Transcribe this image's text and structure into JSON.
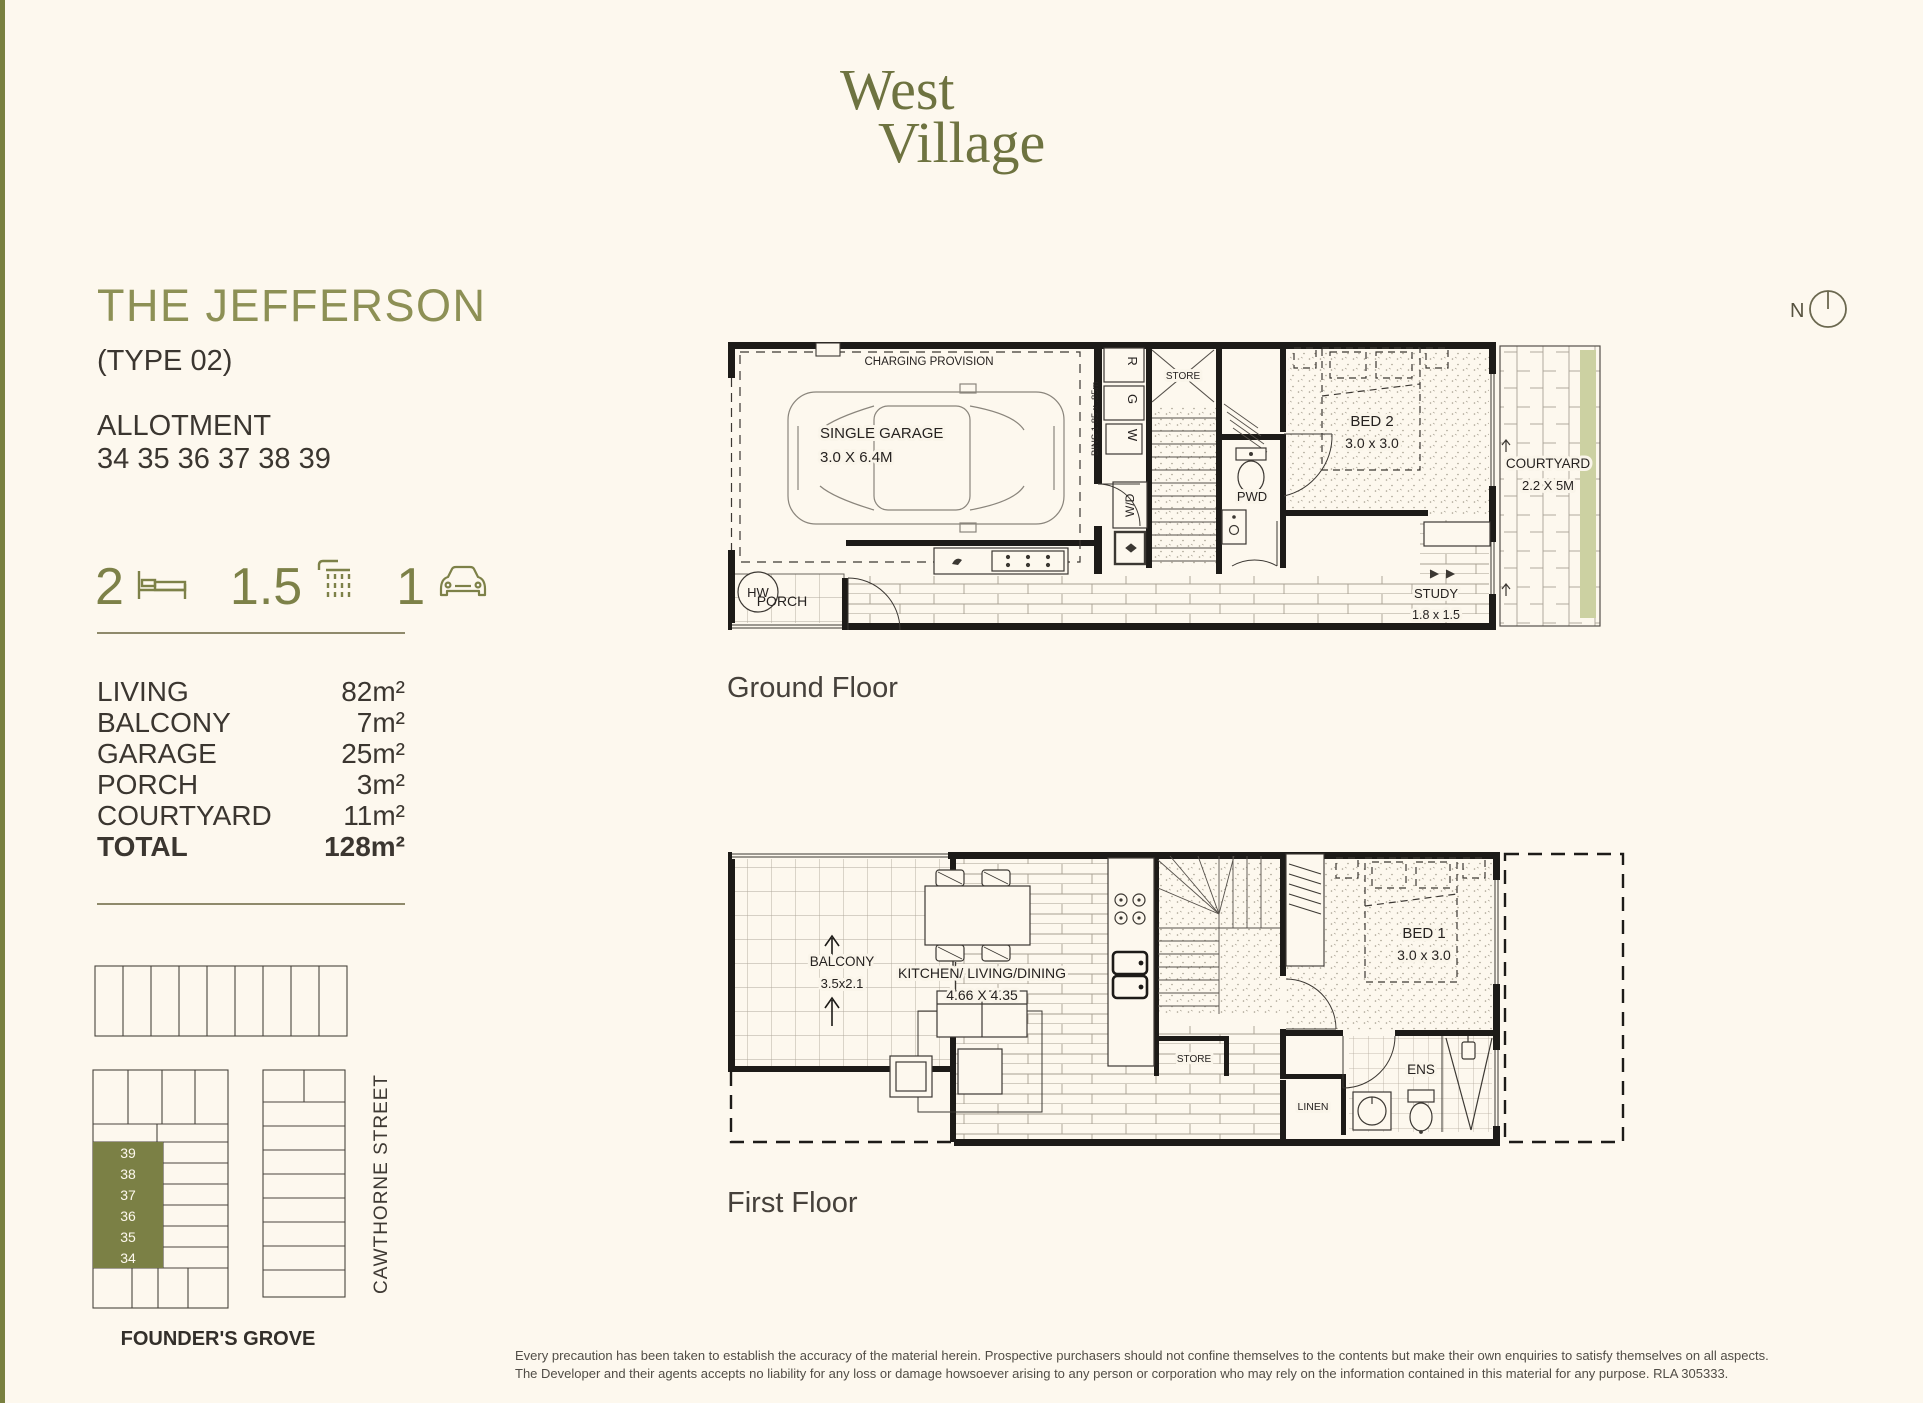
{
  "brand": {
    "line1": "West",
    "line2": "Village"
  },
  "header": {
    "title": "THE JEFFERSON",
    "subtitle": "(TYPE 02)",
    "allotment_label": "ALLOTMENT",
    "allotment_numbers": "34 35 36 37 38 39"
  },
  "stats": [
    {
      "value": "2",
      "icon": "bed-icon"
    },
    {
      "value": "1.5",
      "icon": "shower-icon"
    },
    {
      "value": "1",
      "icon": "car-icon"
    }
  ],
  "areas": {
    "rows": [
      {
        "label": "LIVING",
        "value": "82m²"
      },
      {
        "label": "BALCONY",
        "value": "7m²"
      },
      {
        "label": "GARAGE",
        "value": "25m²"
      },
      {
        "label": "PORCH",
        "value": "3m²"
      },
      {
        "label": "COURTYARD",
        "value": "11m²"
      }
    ],
    "total": {
      "label": "TOTAL",
      "value": "128m²"
    }
  },
  "site_map": {
    "street": "CAWTHORNE STREET",
    "grove": "FOUNDER'S GROVE",
    "lots": [
      "39",
      "38",
      "37",
      "36",
      "35",
      "34"
    ]
  },
  "north": {
    "label": "N"
  },
  "ground_floor": {
    "caption": "Ground Floor",
    "labels": {
      "charging": "CHARGING PROVISION",
      "garage1": "SINGLE GARAGE",
      "garage2": "3.0 X 6.4M",
      "hw": "HW",
      "porch": "PORCH",
      "bins": "BINS 1.85 x .85m",
      "bin_r": "R",
      "bin_g": "G",
      "bin_w": "W",
      "wd": "W/D",
      "store": "STORE",
      "pwd": "PWD",
      "bed2_1": "BED 2",
      "bed2_2": "3.0 x 3.0",
      "study1": "STUDY",
      "study2": "1.8 x 1.5",
      "courtyard1": "COURTYARD",
      "courtyard2": "2.2 X 5M"
    }
  },
  "first_floor": {
    "caption": "First Floor",
    "labels": {
      "balcony1": "BALCONY",
      "balcony2": "3.5x2.1",
      "kld1": "KITCHEN/ LIVING/DINING",
      "kld2": "4.66 X 4.35",
      "store": "STORE",
      "linen": "LINEN",
      "ens": "ENS",
      "bed1_1": "BED 1",
      "bed1_2": "3.0 x 3.0"
    }
  },
  "disclaimer": {
    "line1": "Every precaution has been taken to establish the accuracy of the material herein. Prospective purchasers should not confine themselves to the contents but make their own enquiries to satisfy themselves on all aspects.",
    "line2": "The Developer and their agents accepts no liability for any loss or damage howsoever arising to any person or corporation who may rely on the information contained in this material for any purpose. RLA 305333."
  },
  "colors": {
    "olive": "#79803f",
    "cream": "#fdf8ee",
    "ink": "#3b3630",
    "hedge": "#ccd1a2"
  }
}
